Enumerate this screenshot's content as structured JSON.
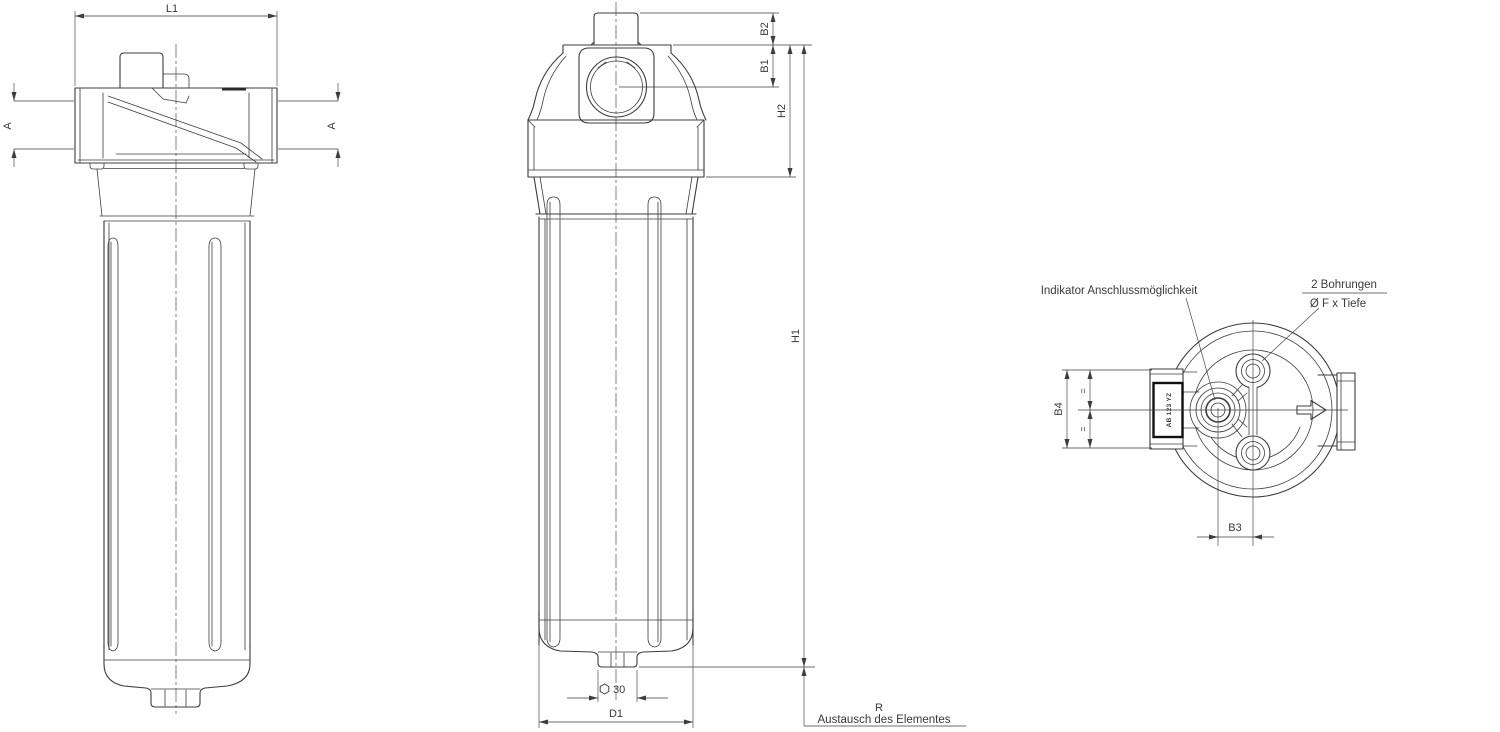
{
  "colors": {
    "line_color": "#3d3d3d",
    "background": "#ffffff"
  },
  "side_view": {
    "dim_l1": "L1",
    "dim_a_left": "A",
    "dim_a_right": "A"
  },
  "front_view": {
    "dim_b2": "B2",
    "dim_b1": "B1",
    "dim_h2": "H2",
    "dim_h1": "H1",
    "dim_hex_size": "30",
    "dim_d1": "D1",
    "dim_r": "R",
    "note_replace": "Austausch des Elementes"
  },
  "top_view": {
    "note_indicator": "Indikator Anschlussmöglichkeit",
    "note_holes_count": "2 Bohrungen",
    "note_holes_size": "Ø F x Tiefe",
    "dim_b4": "B4",
    "dim_b3": "B3",
    "equal_upper": "=",
    "equal_lower": "=",
    "plate_text": "AB 123 YZ"
  }
}
